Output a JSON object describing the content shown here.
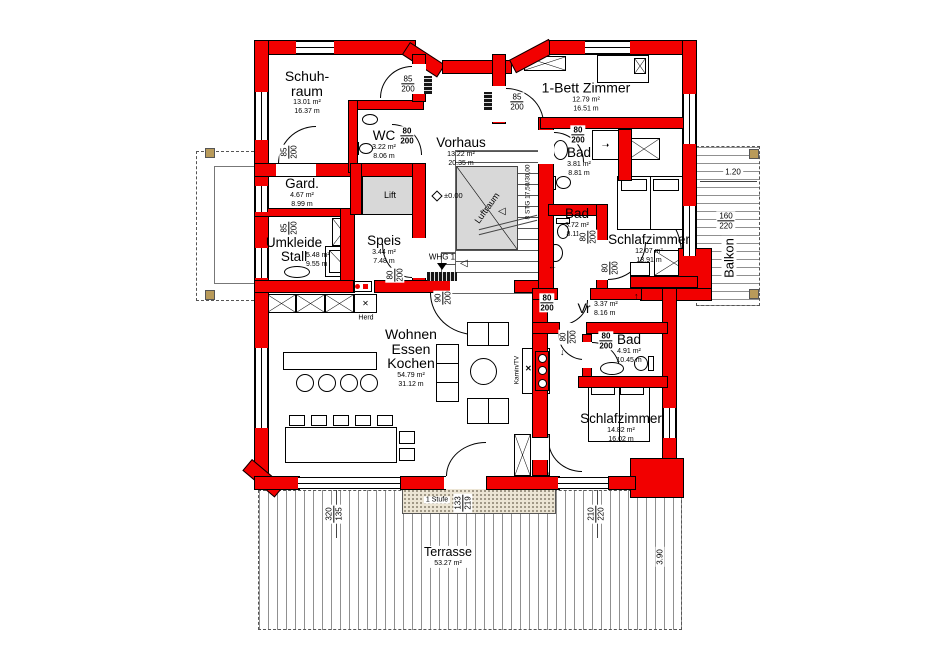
{
  "plan_title": "Erdgeschoss Grundriss (WHG 1)",
  "colors": {
    "wall_red": "#f20000",
    "shaft_gray": "#d8d8d8",
    "concrete": "#ece5d4"
  },
  "rooms": {
    "schuhraum": {
      "name": "Schuh-\nraum",
      "area": "13.01 m²",
      "perimeter": "16.37 m"
    },
    "wc": {
      "name": "WC",
      "area": "3.22 m²",
      "perimeter": "8.06 m"
    },
    "vorhaus": {
      "name": "Vorhaus",
      "area": "13.22 m²",
      "perimeter": "20.35 m"
    },
    "gard": {
      "name": "Gard.",
      "area": "4.67 m²",
      "perimeter": "8.99 m"
    },
    "umkleide": {
      "name": "Umkleide\nStall",
      "area": "5.48 m²",
      "perimeter": "9.55 m"
    },
    "speis": {
      "name": "Speis",
      "area": "3.44 m²",
      "perimeter": "7.48 m"
    },
    "einbett": {
      "name": "1-Bett Zimmer",
      "area": "12.79 m²",
      "perimeter": "16.51 m"
    },
    "bad_top": {
      "name": "Bad",
      "area": "3.81 m²",
      "perimeter": "8.81 m"
    },
    "bad_mid": {
      "name": "Bad",
      "area": "3.72 m²",
      "perimeter": "8.11 m"
    },
    "schlafzimmer1": {
      "name": "Schlafzimmer",
      "area": "12.07 m²",
      "perimeter": "13.91 m"
    },
    "vr": {
      "name": "Vr",
      "area": "3.37 m²",
      "perimeter": "8.16 m"
    },
    "bad_bottom": {
      "name": "Bad",
      "area": "4.91 m²",
      "perimeter": "10.45 m"
    },
    "schlafzimmer2": {
      "name": "Schlafzimmer",
      "area": "14.82 m²",
      "perimeter": "16.02 m"
    },
    "wohnen": {
      "name": "Wohnen\nEssen\nKochen",
      "area": "54.79 m²",
      "perimeter": "31.12 m"
    },
    "terrasse": {
      "name": "Terrasse",
      "area": "53.27 m²"
    },
    "balkon": {
      "name": "Balkon"
    },
    "lift": {
      "name": "Lift"
    },
    "luftraum": {
      "name": "Luftraum"
    }
  },
  "labels": {
    "herd": "Herd",
    "kamin_tv": "Kamin/TV",
    "whg": "WHG 1",
    "level": "±0.00",
    "stufe": "1 Stufe",
    "stairs": "8 STG 17,50/30,00",
    "x_mark": "✕",
    "arrow_right": "➝",
    "arrow_left": "←",
    "arrow_up": "↑",
    "arrow_down": "↓",
    "stair_tri": "◁"
  },
  "dims": {
    "d85": {
      "top": "85",
      "bot": "200"
    },
    "d80": {
      "top": "80",
      "bot": "200"
    },
    "d90": {
      "top": "90",
      "bot": "200"
    },
    "d160": {
      "top": "160",
      "bot": "220"
    },
    "d320": {
      "top": "320",
      "bot": "135"
    },
    "d210": {
      "top": "210",
      "bot": "220"
    },
    "d133": {
      "top": "133",
      "bot": "219"
    },
    "balkon_width": "1.20",
    "terrasse_depth": "3.90"
  }
}
